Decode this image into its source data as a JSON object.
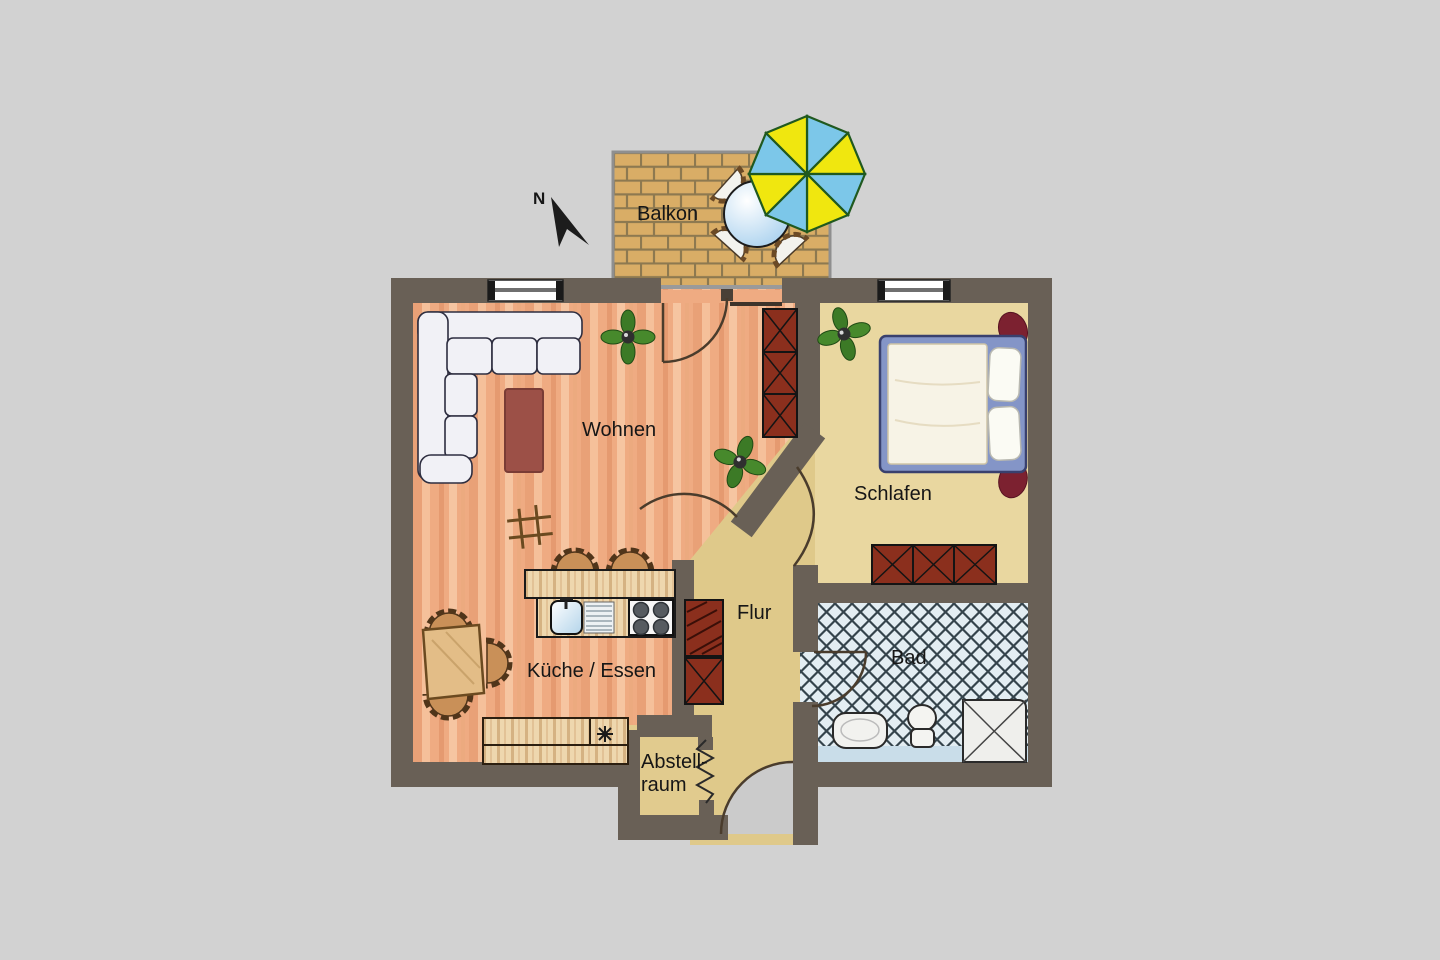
{
  "title": "Apartment floor plan",
  "compass": {
    "north_label": "N"
  },
  "rooms": {
    "balkon": {
      "label": "Balkon"
    },
    "wohnen": {
      "label": "Wohnen"
    },
    "kueche": {
      "label": "Küche / Essen"
    },
    "schlafen": {
      "label": "Schlafen"
    },
    "flur": {
      "label": "Flur"
    },
    "bad": {
      "label": "Bad"
    },
    "abstellraum": {
      "label_line1": "Abstell-",
      "label_line2": "raum"
    }
  },
  "colors": {
    "background": "#d2d2d2",
    "wall": "#696056",
    "floor_wood": "#efab82",
    "floor_bedroom": "#e9d7a0",
    "floor_hall": "#dfc98a",
    "bath_tile": "#e3edf2",
    "bath_tile_line": "#35444c",
    "balcony_brick": "#d9ad66",
    "balcony_grout": "#8d7950",
    "parasol_yellow": "#f0e70f",
    "parasol_blue": "#7cc7e9",
    "furniture_red": "#8b2f1d",
    "coffee_table": "#9c5047",
    "bed_frame_blue": "#8495c7",
    "chair_wicker": "#c99058",
    "sofa_white": "#f1f1f6"
  }
}
